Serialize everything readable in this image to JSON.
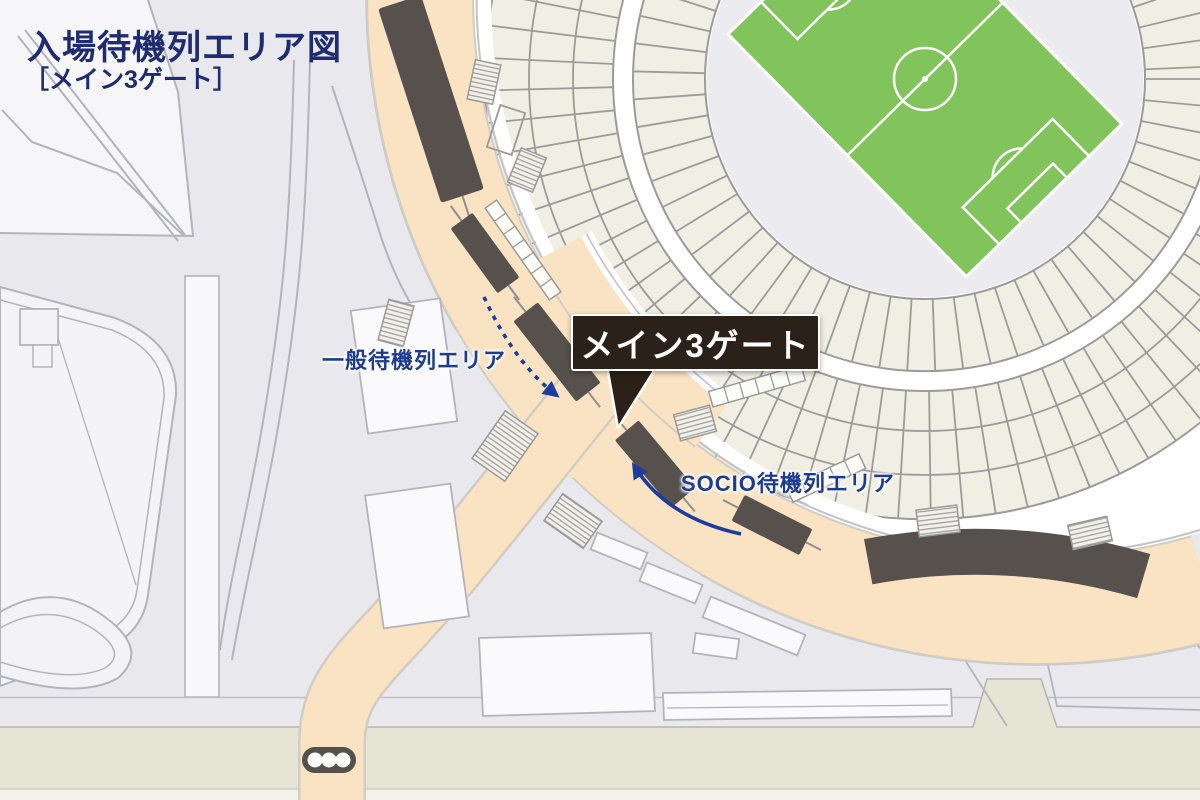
{
  "title": "入場待機列エリア図",
  "subtitle": "［メイン3ゲート］",
  "map": {
    "gate_label": "メイン3ゲート",
    "general_queue_label": "一般待機列エリア",
    "socio_queue_label": "SOCIO待機列エリア"
  },
  "icons": {
    "traffic_light": "traffic-light-icon",
    "general_queue_arrow": "dashed-arrow-icon",
    "socio_queue_arrow": "solid-arrow-icon"
  },
  "colors": {
    "bg": "#e8e8ed",
    "road_peach": "#fae3c3",
    "road_edge": "#d2cdc2",
    "queue_bar": "#57514d",
    "gate_box_bg": "#2b2119",
    "title_navy": "#1e2c72",
    "label_blue": "#1d3c8f",
    "arrow_blue": "#1e3c9c",
    "field_green": "#81c45b",
    "pitch_line": "#ffffff",
    "seat_cream": "#f1efe3",
    "seat_line": "#9b9b9b",
    "band_olive": "#e6e5d5",
    "band_light": "#f2f1ea",
    "building_white": "#fafafc",
    "outline_gray": "#b3b3bb",
    "gray_line": "#c2c2c9",
    "traffic_light_body": "#54504b",
    "concourse_white": "#ffffff"
  }
}
